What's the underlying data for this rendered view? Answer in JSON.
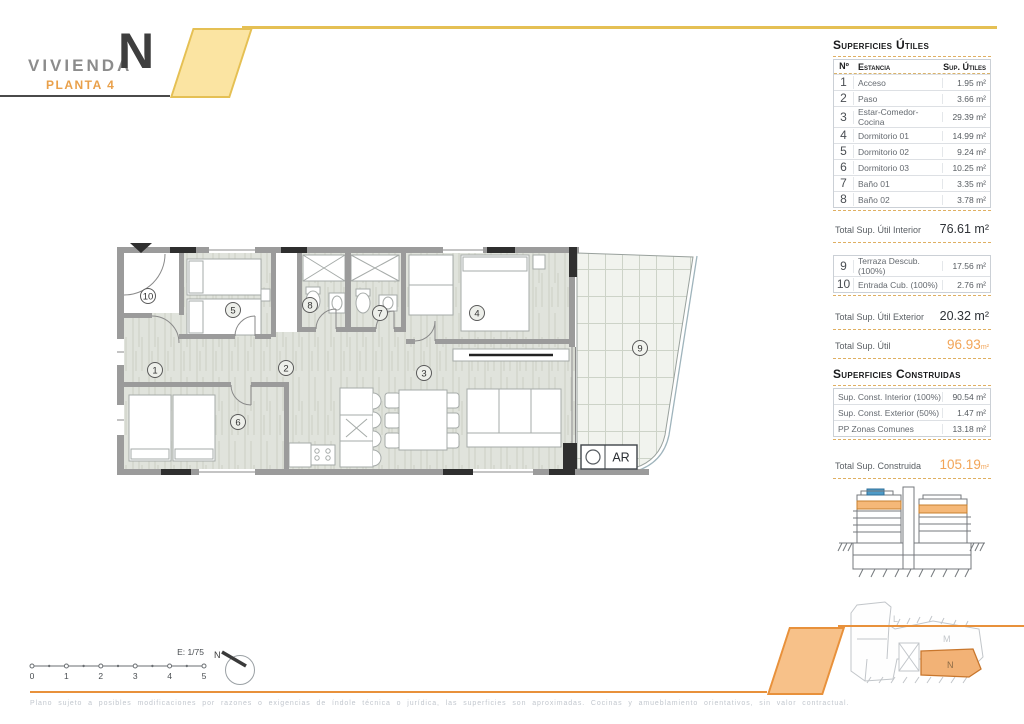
{
  "header": {
    "brand": "VIVIENDA",
    "unit": "N",
    "floor": "PLANTA 4"
  },
  "areas_panel": {
    "utiles": {
      "title": "Superficies Útiles",
      "col_num": "Nº",
      "col_room": "Estancia",
      "col_area": "Sup. Útiles",
      "rows": [
        {
          "num": "1",
          "room": "Acceso",
          "area": "1.95 m²"
        },
        {
          "num": "2",
          "room": "Paso",
          "area": "3.66 m²"
        },
        {
          "num": "3",
          "room": "Estar-Comedor-Cocina",
          "area": "29.39 m²"
        },
        {
          "num": "4",
          "room": "Dormitorio 01",
          "area": "14.99 m²"
        },
        {
          "num": "5",
          "room": "Dormitorio 02",
          "area": "9.24 m²"
        },
        {
          "num": "6",
          "room": "Dormitorio 03",
          "area": "10.25 m²"
        },
        {
          "num": "7",
          "room": "Baño 01",
          "area": "3.35 m²"
        },
        {
          "num": "8",
          "room": "Baño 02",
          "area": "3.78 m²"
        }
      ],
      "total_interior_label": "Total Sup. Útil Interior",
      "total_interior_value": "76.61 m²",
      "exterior_rows": [
        {
          "num": "9",
          "room": "Terraza Descub. (100%)",
          "area": "17.56 m²"
        },
        {
          "num": "10",
          "room": "Entrada Cub. (100%)",
          "area": "2.76 m²"
        }
      ],
      "total_exterior_label": "Total Sup. Útil Exterior",
      "total_exterior_value": "20.32 m²",
      "total_label": "Total Sup. Útil",
      "total_value": "96.93",
      "total_unit": "m²"
    },
    "construidas": {
      "title": "Superficies Construidas",
      "rows": [
        {
          "label": "Sup. Const. Interior (100%)",
          "value": "90.54 m²"
        },
        {
          "label": "Sup. Const. Exterior (50%)",
          "value": "1.47 m²"
        },
        {
          "label": "PP Zonas Comunes",
          "value": "13.18 m²"
        }
      ],
      "total_label": "Total Sup. Construida",
      "total_value": "105.19",
      "total_unit": "m²"
    },
    "site_plan": {
      "block_l": "L",
      "block_m": "M",
      "block_n": "N",
      "highlighted": "N"
    }
  },
  "floor_plan": {
    "rooms": [
      "1",
      "2",
      "3",
      "4",
      "5",
      "6",
      "7",
      "8",
      "9",
      "10"
    ],
    "ar_label": "AR"
  },
  "scale_bar": {
    "scale_label": "E: 1/75",
    "ticks": [
      "0",
      "1",
      "2",
      "3",
      "4",
      "5"
    ],
    "north_label": "N"
  },
  "footer": {
    "disclaimer": "Plano sujeto a posibles modificaciones por razones o exigencias de índole técnica o jurídica, las superficies son aproximadas. Cocinas y amueblamiento orientativos, sin valor contractual."
  },
  "colors": {
    "brand_yellow": "#E5C054",
    "brand_yellow_fill": "#FBE4A2",
    "accent_orange": "#E8913B",
    "accent_orange_fill": "#F7C189",
    "total_orange_text": "#F2A558",
    "plan_highlight": "#F2B276",
    "elevation_blue": "#4E9BC8"
  }
}
